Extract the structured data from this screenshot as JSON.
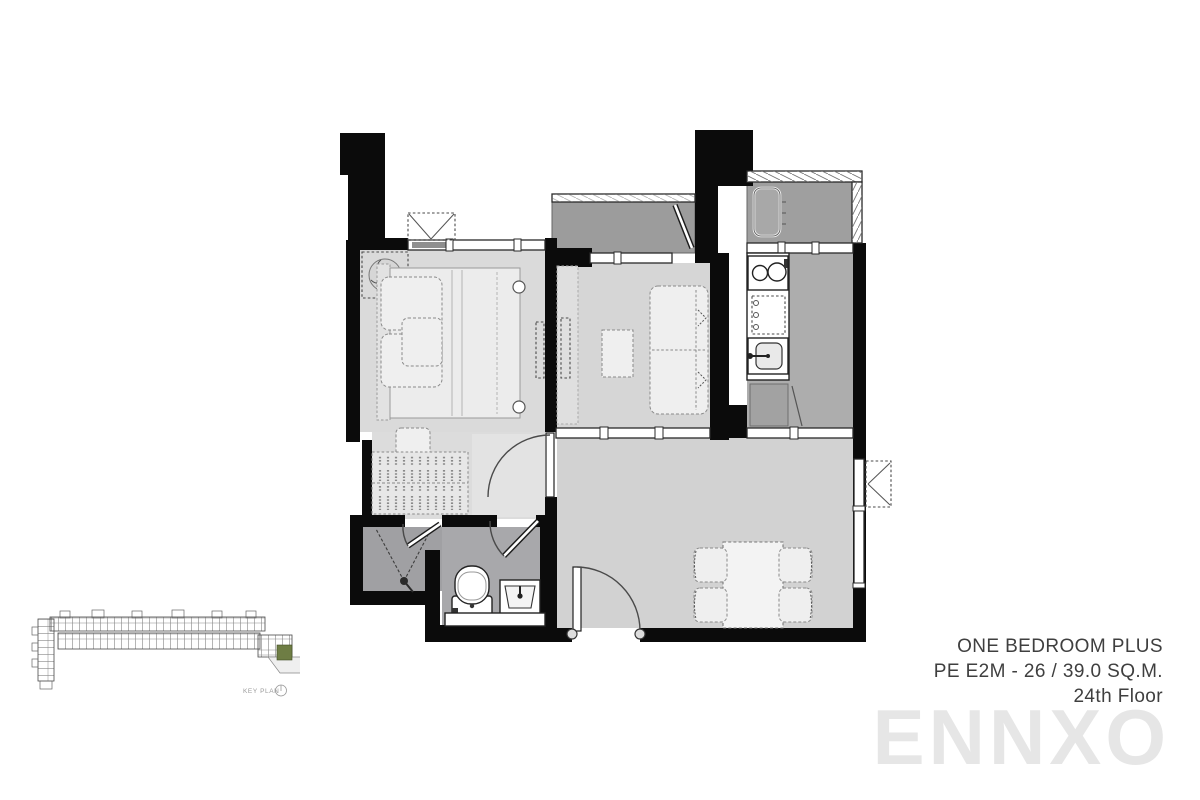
{
  "page": {
    "background_color": "#ffffff"
  },
  "unit_info": {
    "type_name": "ONE BEDROOM PLUS",
    "unit_code": "PE E2M - 26 / 39.0 SQ.M.",
    "floor": "24th Floor",
    "text_color": "#3f3f3f"
  },
  "watermark": {
    "text": "ENNXO",
    "color": "#e6e6e6"
  },
  "key_plan": {
    "label": "KEY PLAN",
    "highlight_color": "#6e7d44",
    "description": "building footprint with highlighted unit at right end"
  },
  "floor_plan": {
    "wall_color": "#0b0b0b",
    "rooms": [
      {
        "name": "bedroom",
        "floor_color": "#dadada",
        "fixtures": [
          "double-bed",
          "pillows",
          "ceiling-fan",
          "wardrobe-hangers",
          "stool",
          "wall-tv",
          "window",
          "ac-condenser-ledge"
        ]
      },
      {
        "name": "multipurpose-room",
        "floor_color": "#d6d6d6",
        "fixtures": [
          "sofa-bed",
          "coffee-table",
          "tv-console",
          "sliding-partition"
        ]
      },
      {
        "name": "balcony",
        "floor_color": "#9c9c9c",
        "fixtures": [
          "balcony-door",
          "railing"
        ]
      },
      {
        "name": "kitchen",
        "floor_color": "#adadad",
        "fixtures": [
          "two-burner-stove",
          "counter",
          "sink",
          "refrigerator"
        ]
      },
      {
        "name": "service-ledge",
        "floor_color": "#9f9f9f",
        "fixtures": [
          "ac-condenser",
          "louver-railing"
        ]
      },
      {
        "name": "bathroom",
        "floor_color": "#a6a6a9",
        "fixtures": [
          "shower",
          "toilet",
          "basin-vanity",
          "vanity-counter"
        ]
      },
      {
        "name": "living-dining",
        "floor_color": "#d2d2d2",
        "fixtures": [
          "dining-table",
          "four-chairs",
          "entrance-door",
          "windows",
          "ac-unit"
        ]
      }
    ]
  }
}
